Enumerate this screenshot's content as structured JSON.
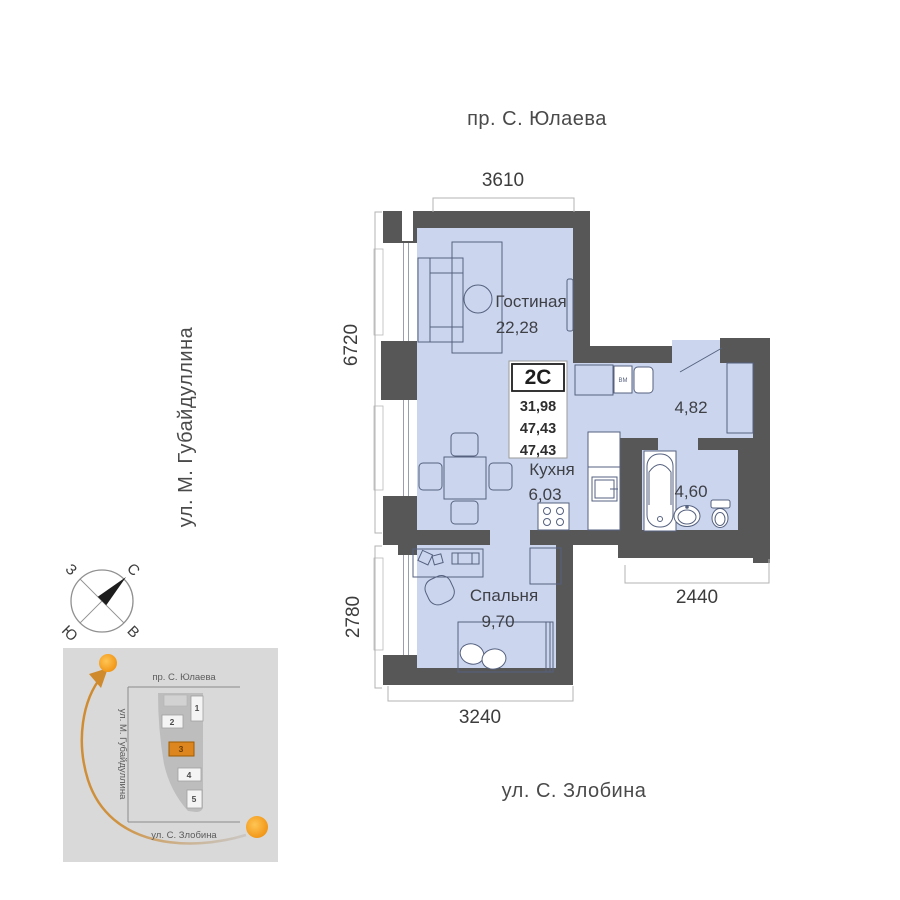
{
  "streets": {
    "top": "пр. С. Юлаева",
    "left": "ул. М. Губайдуллина",
    "bottom": "ул. С. Злобина"
  },
  "dimensions": {
    "top": "3610",
    "left_upper": "6720",
    "left_lower": "2780",
    "bottom": "3240",
    "right_lower": "2440"
  },
  "info_card": {
    "type": "2С",
    "rows": [
      "31,98",
      "47,43",
      "47,43"
    ]
  },
  "rooms": {
    "living": {
      "name": "Гостиная",
      "area": "22,28"
    },
    "kitchen": {
      "name": "Кухня",
      "area": "6,03"
    },
    "bedroom": {
      "name": "Спальня",
      "area": "9,70"
    },
    "hallway": {
      "area": "4,82"
    },
    "bathroom": {
      "area": "4,60"
    }
  },
  "labels": {
    "washing_machine": "ВМ"
  },
  "compass": {
    "north": "С",
    "east": "В",
    "south": "Ю",
    "west": "З"
  },
  "minimap": {
    "street_top": "пр. С. Юлаева",
    "street_left": "ул. М. Губайдуллина",
    "street_bottom": "ул. С. Злобина",
    "blocks": [
      {
        "num": "1"
      },
      {
        "num": "2"
      },
      {
        "num": "3"
      },
      {
        "num": "4"
      },
      {
        "num": "5"
      }
    ],
    "highlighted_block": "3"
  },
  "colors": {
    "wall": "#575757",
    "floor": "#cbd6ee",
    "floor_stroke": "#55617f",
    "accent": "#e0861c",
    "dim_text": "#3d3d3d",
    "street_text": "#4a4a4a"
  }
}
